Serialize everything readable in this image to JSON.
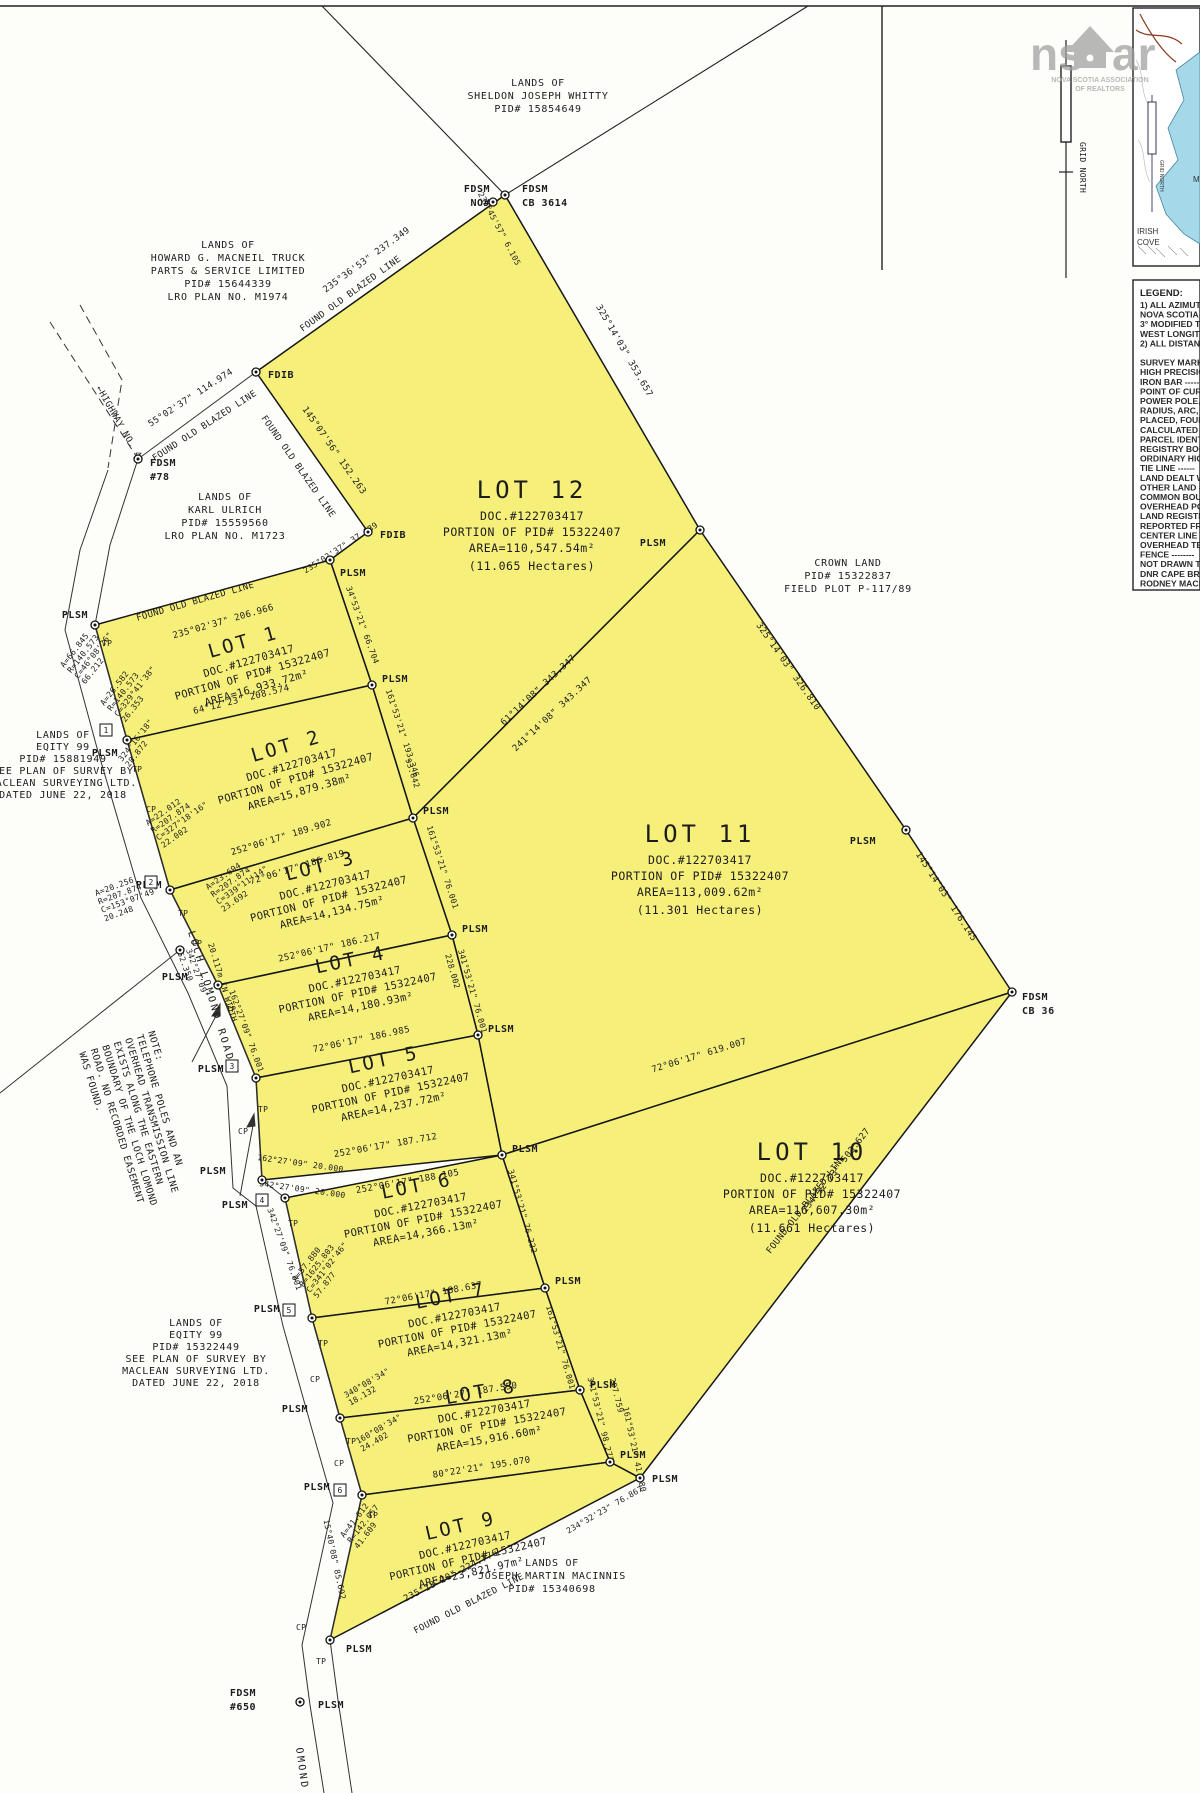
{
  "watermark": {
    "logo_left": "ns",
    "logo_right": "ar",
    "caption1": "NOVA SCOTIA ASSOCIATION",
    "caption2": "OF REALTORS"
  },
  "north_arrow": {
    "label": "GRID NORTH"
  },
  "inset": {
    "irish1": "IRISH",
    "irish2": "COVE",
    "grid_north": "GRID NORTH",
    "m_partial": "M"
  },
  "legend": {
    "title": "LEGEND:",
    "lines": [
      "1) ALL AZIMUTHS",
      "NOVA SCOTIA H",
      "3° MODIFIED TR",
      "WEST LONGITUD",
      "2) ALL DISTANCE",
      "",
      "SURVEY MARKER",
      "HIGH PRECISION",
      "IRON BAR  -----",
      "POINT OF CURVA",
      "POWER POLE, TE",
      "RADIUS, ARC, CH",
      "PLACED, FOUND,",
      "CALCULATED",
      "PARCEL IDENTIFI",
      "REGISTRY BOOK",
      "ORDINARY HIGH",
      "TIE LINE  ------",
      "LAND DEALT WIT",
      "OTHER LAND  --",
      "COMMON BOUND",
      "OVERHEAD POW",
      "LAND REGISTRY",
      "REPORTED FROM",
      "CENTER LINE  --",
      "OVERHEAD TELE",
      "FENCE  --------",
      "NOT DRAWN TO",
      "DNR CAPE BRET",
      "RODNEY MACLE"
    ]
  },
  "lots": [
    {
      "name": "LOT 1",
      "doc": "DOC.#122703417",
      "pid": "PORTION OF PID# 15322407",
      "area": "AREA=16,933.72m²"
    },
    {
      "name": "LOT 2",
      "doc": "DOC.#122703417",
      "pid": "PORTION OF PID# 15322407",
      "area": "AREA=15,879.38m²"
    },
    {
      "name": "LOT 3",
      "doc": "DOC.#122703417",
      "pid": "PORTION OF PID# 15322407",
      "area": "AREA=14,134.75m²"
    },
    {
      "name": "LOT 4",
      "doc": "DOC.#122703417",
      "pid": "PORTION OF PID# 15322407",
      "area": "AREA=14,180.93m²"
    },
    {
      "name": "LOT 5",
      "doc": "DOC.#122703417",
      "pid": "PORTION OF PID# 15322407",
      "area": "AREA=14,237.72m²"
    },
    {
      "name": "LOT 6",
      "doc": "DOC.#122703417",
      "pid": "PORTION OF PID# 15322407",
      "area": "AREA=14,366.13m²"
    },
    {
      "name": "LOT 7",
      "doc": "DOC.#122703417",
      "pid": "PORTION OF PID# 15322407",
      "area": "AREA=14,321.13m²"
    },
    {
      "name": "LOT 8",
      "doc": "DOC.#122703417",
      "pid": "PORTION OF PID# 15322407",
      "area": "AREA=15,916.60m²"
    },
    {
      "name": "LOT 9",
      "doc": "DOC.#122703417",
      "pid": "PORTION OF PID# 15322407",
      "area": "AREA=23,821.97m²"
    },
    {
      "name": "LOT 10",
      "doc": "DOC.#122703417",
      "pid": "PORTION OF PID# 15322407",
      "area": "AREA=116,607.30m²",
      "hectares": "(11.661 Hectares)"
    },
    {
      "name": "LOT 11",
      "doc": "DOC.#122703417",
      "pid": "PORTION OF PID# 15322407",
      "area": "AREA=113,009.62m²",
      "hectares": "(11.301 Hectares)"
    },
    {
      "name": "LOT 12",
      "doc": "DOC.#122703417",
      "pid": "PORTION OF PID# 15322407",
      "area": "AREA=110,547.54m²",
      "hectares": "(11.065 Hectares)"
    }
  ],
  "owners": [
    {
      "lines": [
        "LANDS OF",
        "SHELDON JOSEPH WHITTY",
        "PID# 15854649"
      ]
    },
    {
      "lines": [
        "LANDS OF",
        "HOWARD G. MACNEIL TRUCK",
        "PARTS & SERVICE LIMITED",
        "PID# 15644339",
        "LRO PLAN NO. M1974"
      ]
    },
    {
      "lines": [
        "LANDS OF",
        "KARL ULRICH",
        "PID# 15559560",
        "LRO PLAN NO. M1723"
      ]
    },
    {
      "lines": [
        "LANDS OF",
        "EQITY 99",
        "PID# 15881949",
        "SEE PLAN OF SURVEY BY",
        "MACLEAN SURVEYING LTD.",
        "DATED JUNE 22, 2018"
      ]
    },
    {
      "lines": [
        "CROWN LAND",
        "PID# 15322837",
        "FIELD PLOT P-117/89"
      ]
    },
    {
      "lines": [
        "LANDS OF",
        "EQITY 99",
        "PID# 15322449",
        "SEE PLAN OF SURVEY BY",
        "MACLEAN SURVEYING LTD.",
        "DATED JUNE 22, 2018"
      ]
    },
    {
      "lines": [
        "LANDS OF",
        "JOSEPH MARTIN MACINNIS",
        "PID# 15340698"
      ]
    }
  ],
  "bearings": [
    "230°45'57\" 6.105",
    "235°36'53\" 237.349",
    "FOUND OLD BLAZED LINE",
    "325°14'03\" 353.657",
    "55°02'37\" 114.974",
    "FOUND OLD BLAZED LINE",
    "FOUND OLD BLAZED LINE",
    "145°07'56\" 152.263",
    "235°02'37\" 37.139",
    "FOUND OLD BLAZED LINE",
    "235°02'37\" 206.966",
    "34°53'21\" 66.704",
    "64°12'23\" 208.574",
    "161°53'21\" 193.346",
    "93.642",
    "252°06'17\" 189.902",
    "72°06'17\" 186.819",
    "161°53'21\" 76.001",
    "252°06'17\" 186.217",
    "228.002",
    "341°53'21\" 76.001",
    "72°06'17\" 186.985",
    "252°06'17\" 187.712",
    "162°27'09\" 20.000",
    "342°27'09\" 20.000",
    "252°06'17\" 188.105",
    "341°53'21\" 76.222",
    "72°06'17\" 188.637",
    "161°53'21\" 76.001",
    "252°06'27\" 187.550",
    "341°53'21\" 98.277",
    "297.759",
    "80°22'21\" 195.070",
    "161°53'21\" 41.280",
    "61°14'08\" 343.347",
    "241°14'08\" 343.347",
    "325°14'03\" 326.810",
    "145°14'03\" 176.145",
    "72°06'17\" 619.007",
    "FOUND OLD BLAZED LINE",
    "234°32'23\" 503.627",
    "FOUND OLD BLAZED LINE",
    "235°18'20\" 224.776",
    "234°32'23\" 76.867",
    "15°40'08\" 85.692",
    "162°27'09\" 76.001",
    "342°27'09\" 76.001"
  ],
  "curve_blocks": [
    {
      "lines": [
        "A=66.845",
        "R=140.573",
        "C=46°08'26\"",
        "66.212"
      ]
    },
    {
      "lines": [
        "A=26.582",
        "R=140.573",
        "C=329°41'38\"",
        "26.353"
      ]
    },
    {
      "lines": [
        "324°16'18\"",
        "28.872"
      ]
    },
    {
      "lines": [
        "A=22.012",
        "R=207.874",
        "C=327°18'16\"",
        "22.002"
      ]
    },
    {
      "lines": [
        "A=20.256",
        "R=207.874",
        "C=153°07'49\"",
        "20.248"
      ]
    },
    {
      "lines": [
        "A=23.694",
        "R=207.874",
        "C=339°11'14\"",
        "23.692"
      ]
    },
    {
      "lines": [
        "342°27'09\"",
        "52.350"
      ]
    },
    {
      "lines": [
        "A=57.880",
        "R=1625.803",
        "C=341°02'46\"",
        "57.877"
      ]
    },
    {
      "lines": [
        "340°08'34\"",
        "18.132"
      ]
    },
    {
      "lines": [
        "160°08'34\"",
        "24.402"
      ]
    },
    {
      "lines": [
        "A=41.612",
        "R=142.057",
        "41.609"
      ]
    }
  ],
  "markers": {
    "plsm": "PLSM",
    "tp": "TP",
    "cp": "CP",
    "fdib": "FDIB",
    "fdsm": "FDSM",
    "no": "NO#",
    "cb3614": "CB 3614",
    "n78": "#78",
    "n650": "#650",
    "cb36": "CB 36"
  },
  "roads": {
    "loch_lomond": "LOCH LOMOND ROAD",
    "width_note": "20.117m IN WIDTH",
    "highway": "←HIGHWAY NO. 4",
    "lomond_partial": "OMOND"
  },
  "note": {
    "lines": [
      "NOTE:",
      "TELEPHONE POLES AND AN",
      "OVERHEAD TRANSMISSION LINE",
      "EXISTS ALONG THE EASTERN",
      "BOUNDARY OF THE LOCH LOMOND",
      "ROAD. NO RECORDED EASEMENT",
      "WAS FOUND."
    ]
  },
  "route_boxes": [
    "1",
    "2",
    "3",
    "4",
    "5",
    "6"
  ],
  "colors": {
    "lot_fill": "#f6f07b",
    "water": "#a5d8e8"
  }
}
